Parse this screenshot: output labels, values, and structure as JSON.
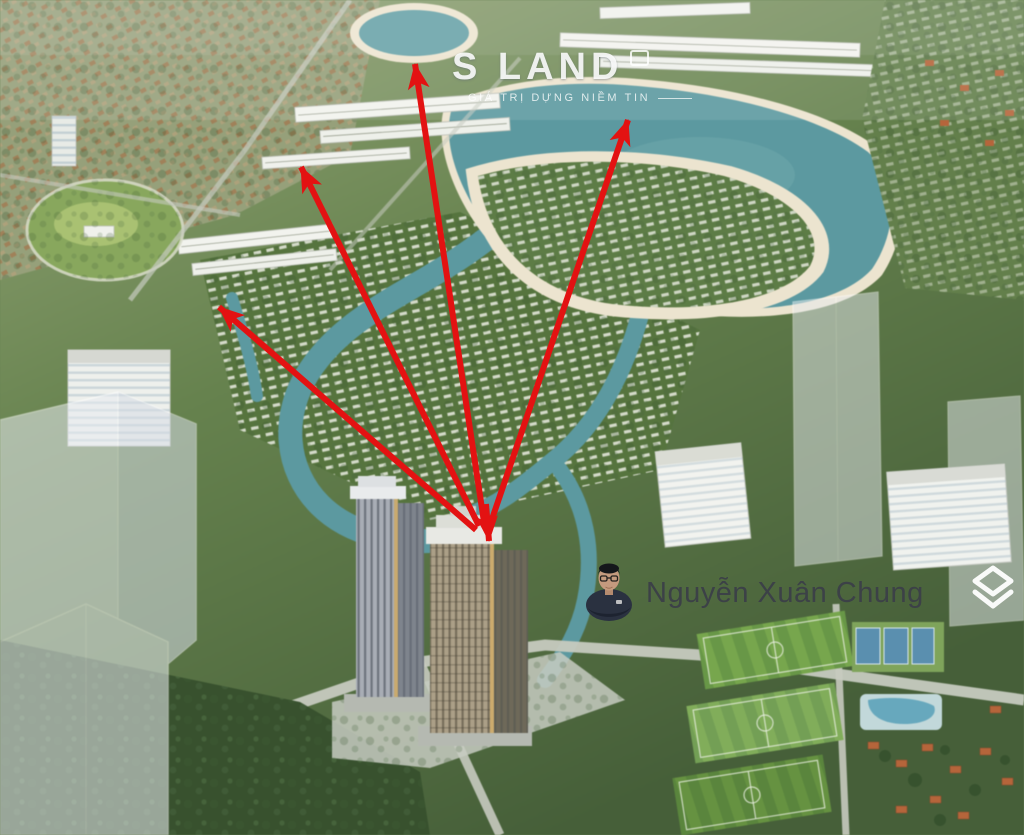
{
  "watermark": {
    "brand": "S LAND",
    "tagline": "GIÁ TRỊ DỰNG NIỀM TIN"
  },
  "agent": {
    "name": "Nguyễn Xuân Chung"
  },
  "annotations": {
    "arrow_color": "#e31212",
    "arrows": [
      {
        "x1": 484,
        "y1": 522,
        "x2": 415,
        "y2": 64
      },
      {
        "x1": 479,
        "y1": 526,
        "x2": 301,
        "y2": 167
      },
      {
        "x1": 491,
        "y1": 522,
        "x2": 628,
        "y2": 120
      },
      {
        "x1": 476,
        "y1": 530,
        "x2": 219,
        "y2": 307
      },
      {
        "x1": 486,
        "y1": 504,
        "x2": 489,
        "y2": 541
      }
    ]
  },
  "scene_colors": {
    "water": "#5d99a0",
    "sand": "#ece4cf",
    "vegetation": "#5d7c47",
    "vegetation_dark": "#3c5832",
    "ghost_tower": "#e7ebf0",
    "name_text": "#3c4147",
    "arrow_red": "#e31212"
  }
}
